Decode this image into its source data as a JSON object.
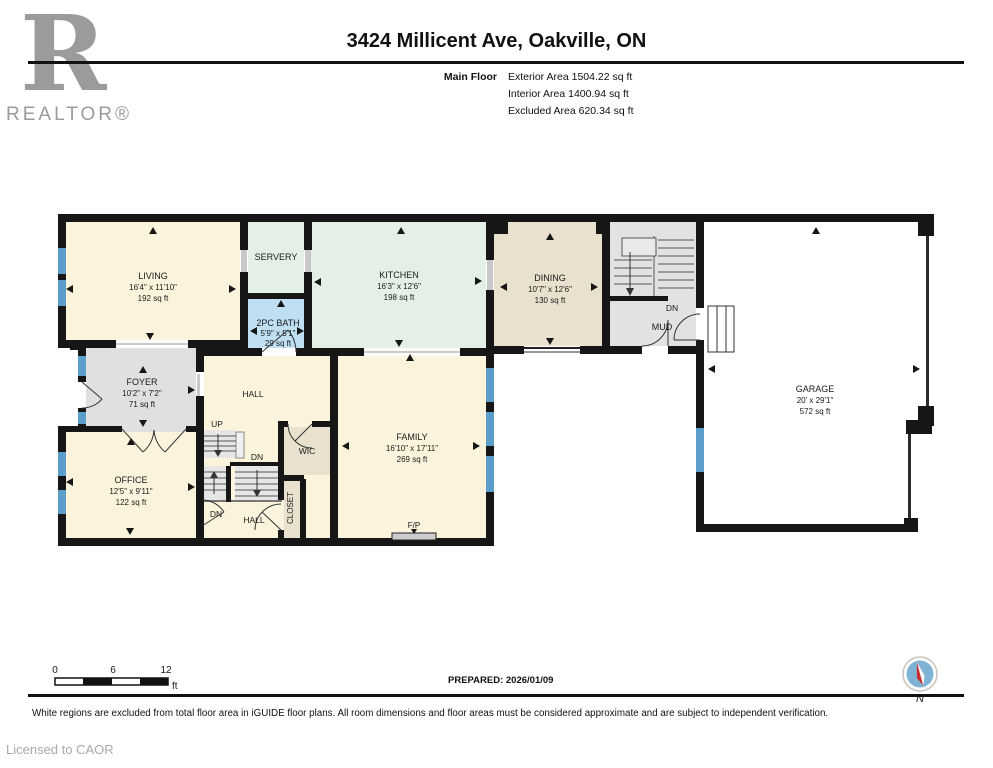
{
  "header": {
    "logo_r": "R",
    "logo_word": "REALTOR®",
    "title": "3424 Millicent Ave, Oakville, ON",
    "floor_label": "Main Floor",
    "exterior_area": "Exterior Area 1504.22 sq ft",
    "interior_area": "Interior Area 1400.94 sq ft",
    "excluded_area": "Excluded Area 620.34 sq ft"
  },
  "plan": {
    "rooms": {
      "living": {
        "name": "LIVING",
        "dims": "16'4\" x 11'10\"",
        "area": "192 sq ft"
      },
      "servery": {
        "name": "SERVERY"
      },
      "bath": {
        "name": "2PC BATH",
        "dims": "5'9\" x 5'1\"",
        "area": "29 sq ft"
      },
      "kitchen": {
        "name": "KITCHEN",
        "dims": "16'3\" x 12'6\"",
        "area": "198 sq ft"
      },
      "dining": {
        "name": "DINING",
        "dims": "10'7\" x 12'6\"",
        "area": "130 sq ft"
      },
      "mud": {
        "name": "MUD"
      },
      "garage": {
        "name": "GARAGE",
        "dims": "20' x 29'1\"",
        "area": "572 sq ft"
      },
      "foyer": {
        "name": "FOYER",
        "dims": "10'2\" x 7'2\"",
        "area": "71 sq ft"
      },
      "office": {
        "name": "OFFICE",
        "dims": "12'5\" x 9'11\"",
        "area": "122 sq ft"
      },
      "family": {
        "name": "FAMILY",
        "dims": "16'10\" x 17'11\"",
        "area": "269 sq ft"
      },
      "hall": {
        "name": "HALL"
      },
      "wic": {
        "name": "WIC"
      },
      "closet": {
        "name": "CLOSET"
      }
    },
    "labels": {
      "up": "UP",
      "dn": "DN",
      "fp": "F/P"
    },
    "colors": {
      "wall": "#161616",
      "window_blue": "#5B9EC9",
      "cream": "#FBF3DC",
      "mint": "#E4F0E5",
      "tan": "#EAE0CE",
      "bath_blue": "#BFDFF2",
      "gray": "#E0E0E0",
      "compass_red": "#CC2A2A"
    }
  },
  "footer": {
    "scale": {
      "t0": "0",
      "t6": "6",
      "t12": "12",
      "unit": "ft"
    },
    "prepared": "PREPARED: 2026/01/09",
    "compass_label": "N",
    "disclaimer": "White regions are excluded from total floor area in iGUIDE floor plans. All room dimensions and floor areas must be considered approximate and are subject to independent verification.",
    "license": "Licensed to CAOR"
  }
}
